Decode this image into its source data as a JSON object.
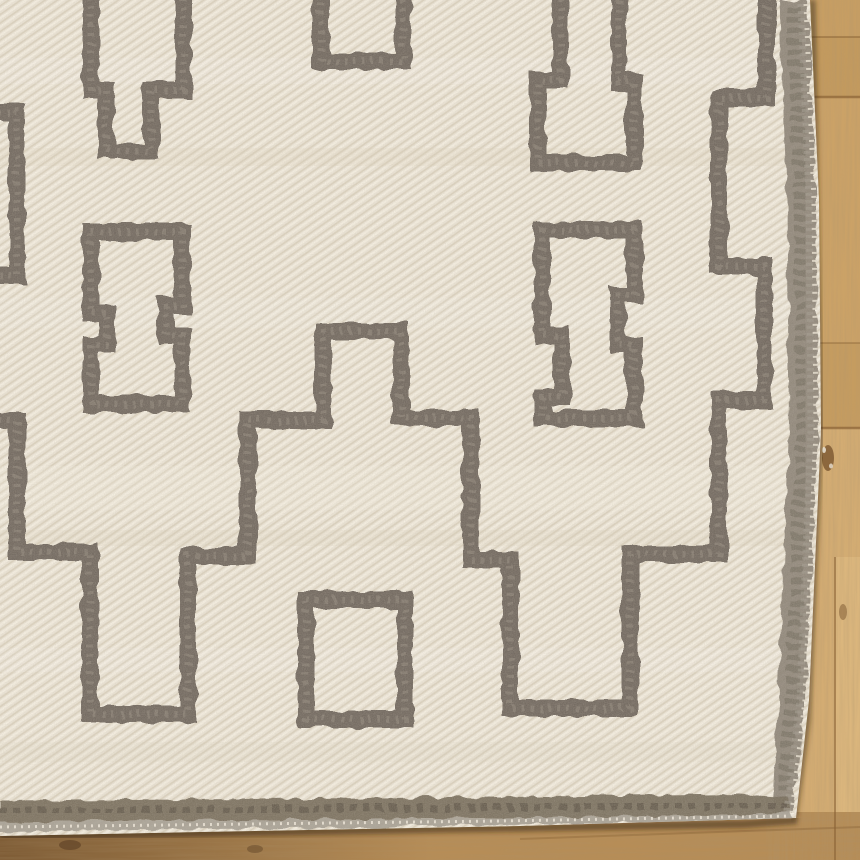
{
  "scene": {
    "description": "Close-up corner of a cream handwoven flatweave kilim rug with a charcoal-gray geometric Greek-key and stepped-medallion pattern, lying on a honey oak plank wood floor visible along the right side and bottom edge",
    "canvas": {
      "width": 860,
      "height": 860
    }
  },
  "palette": {
    "wood_base": "#c49b60",
    "wood_light_plank": "#d3ac73",
    "wood_seam": "#8a6336",
    "wood_shadow": "#3a2814",
    "rug_cream": "#eae3d5",
    "rug_cream_light": "#f4eee1",
    "rug_cream_dark": "#dbd2bf",
    "motif_gray": "#6c6259",
    "motif_fleck": "#9a9184",
    "border_gray": "#8b8377",
    "selvage_gray": "#a59e93"
  },
  "floor_shapes": [
    {
      "t": "rect",
      "n": "wood-base",
      "a": {
        "x": 0,
        "y": 0,
        "width": 860,
        "height": 860,
        "fill": "#c49b60"
      }
    },
    {
      "t": "rect",
      "n": "wood-plank",
      "a": {
        "x": 766,
        "y": 0,
        "width": 94,
        "height": 37,
        "fill": "#c79e63"
      }
    },
    {
      "t": "rect",
      "n": "wood-plank",
      "a": {
        "x": 766,
        "y": 37,
        "width": 94,
        "height": 60,
        "fill": "#c39a5e"
      }
    },
    {
      "t": "rect",
      "n": "wood-plank",
      "a": {
        "x": 766,
        "y": 97,
        "width": 94,
        "height": 246,
        "fill": "#cba267"
      }
    },
    {
      "t": "rect",
      "n": "wood-plank",
      "a": {
        "x": 766,
        "y": 343,
        "width": 94,
        "height": 85,
        "fill": "#c59c60"
      }
    },
    {
      "t": "rect",
      "n": "wood-plank",
      "a": {
        "x": 766,
        "y": 428,
        "width": 94,
        "height": 432,
        "fill": "#d3ac73"
      }
    },
    {
      "t": "rect",
      "n": "wood-plank",
      "a": {
        "x": 834,
        "y": 557,
        "width": 26,
        "height": 303,
        "fill": "#dbb67d"
      }
    },
    {
      "t": "rect",
      "n": "wood-plank",
      "a": {
        "x": 0,
        "y": 812,
        "width": 860,
        "height": 48,
        "fill": "#b68d57"
      }
    },
    {
      "t": "rect",
      "n": "wood-shading-bottom-left",
      "a": {
        "x": 0,
        "y": 812,
        "width": 430,
        "height": 48,
        "fill": "url(#gradBL)"
      }
    },
    {
      "t": "rect",
      "n": "wood-grain-vertical",
      "a": {
        "x": 766,
        "y": 0,
        "width": 94,
        "height": 860,
        "filter": "url(#grainV)",
        "opacity": "0.5"
      }
    },
    {
      "t": "rect",
      "n": "wood-grain-horizontal",
      "a": {
        "x": 0,
        "y": 812,
        "width": 860,
        "height": 48,
        "filter": "url(#grainH)",
        "opacity": "0.45"
      }
    },
    {
      "t": "path",
      "n": "plank-seam",
      "a": {
        "d": "M 766,37 H 860",
        "stroke": "#8a6336",
        "stroke-width": "2",
        "opacity": "0.5",
        "fill": "none"
      }
    },
    {
      "t": "path",
      "n": "plank-seam",
      "a": {
        "d": "M 766,97 H 860",
        "stroke": "#8a6336",
        "stroke-width": "2.5",
        "opacity": "0.7",
        "fill": "none"
      }
    },
    {
      "t": "path",
      "n": "plank-seam",
      "a": {
        "d": "M 766,343 H 860",
        "stroke": "#8a6336",
        "stroke-width": "2",
        "opacity": "0.4",
        "fill": "none"
      }
    },
    {
      "t": "path",
      "n": "plank-seam",
      "a": {
        "d": "M 766,428 H 860",
        "stroke": "#8a6336",
        "stroke-width": "2.5",
        "opacity": "0.7",
        "fill": "none"
      }
    },
    {
      "t": "path",
      "n": "plank-seam",
      "a": {
        "d": "M 835,557 V 860",
        "stroke": "#8a6336",
        "stroke-width": "2",
        "opacity": "0.6",
        "fill": "none"
      }
    },
    {
      "t": "path",
      "n": "plank-seam",
      "a": {
        "d": "M 520,839 L 860,827",
        "stroke": "#8a6336",
        "stroke-width": "2",
        "opacity": "0.4",
        "fill": "none"
      }
    },
    {
      "t": "ellipse",
      "n": "wood-knot",
      "a": {
        "cx": 828,
        "cy": 458,
        "rx": 6,
        "ry": 13,
        "fill": "#7a5630",
        "opacity": "0.8"
      }
    },
    {
      "t": "ellipse",
      "n": "wood-knot-speck",
      "a": {
        "cx": 824,
        "cy": 450,
        "rx": 2,
        "ry": 3,
        "fill": "#e8e0d0",
        "opacity": "0.9"
      }
    },
    {
      "t": "ellipse",
      "n": "wood-knot-speck",
      "a": {
        "cx": 831,
        "cy": 466,
        "rx": 2,
        "ry": 2.5,
        "fill": "#e8e0d0",
        "opacity": "0.8"
      }
    },
    {
      "t": "ellipse",
      "n": "wood-knot",
      "a": {
        "cx": 843,
        "cy": 612,
        "rx": 4,
        "ry": 8,
        "fill": "#7a5630",
        "opacity": "0.5"
      }
    },
    {
      "t": "ellipse",
      "n": "wood-knot",
      "a": {
        "cx": 70,
        "cy": 845,
        "rx": 11,
        "ry": 5,
        "fill": "#64472a",
        "opacity": "0.75"
      }
    },
    {
      "t": "ellipse",
      "n": "wood-knot",
      "a": {
        "cx": 255,
        "cy": 849,
        "rx": 8,
        "ry": 4,
        "fill": "#64472a",
        "opacity": "0.5"
      }
    },
    {
      "t": "path",
      "n": "rug-cast-shadow-right",
      "a": {
        "d": "M 812,0 L 820,430 L 807,720 L 794,818",
        "stroke": "rgba(58,40,20,0.5)",
        "stroke-width": "7",
        "fill": "none",
        "filter": "url(#soft)"
      }
    },
    {
      "t": "path",
      "n": "rug-cast-shadow-bottom",
      "a": {
        "d": "M 0,836 L 745,824 L 797,820",
        "stroke": "rgba(58,40,20,0.55)",
        "stroke-width": "8",
        "fill": "none",
        "filter": "url(#soft)"
      }
    }
  ],
  "rug": {
    "clip_d": "M 0,0 L 810,0 L 819,200 L 821,430 L 809,700 L 796,818 L 520,826 L 200,832 L 0,836 Z",
    "field": {
      "t": "rect",
      "n": "rug-field",
      "a": {
        "x": 0,
        "y": 0,
        "width": 860,
        "height": 860,
        "fill": "url(#twill)"
      }
    },
    "weave_bands": [
      {
        "y": 58,
        "h": 26,
        "fill": "#ffffff",
        "opacity": 0.1
      },
      {
        "y": 148,
        "h": 18,
        "fill": "#d7ccb7",
        "opacity": 0.16
      },
      {
        "y": 298,
        "h": 30,
        "fill": "#ffffff",
        "opacity": 0.08
      },
      {
        "y": 466,
        "h": 44,
        "fill": "#f6f0e2",
        "opacity": 0.22
      },
      {
        "y": 530,
        "h": 16,
        "fill": "#d7ccb7",
        "opacity": 0.18
      },
      {
        "y": 648,
        "h": 24,
        "fill": "#ffffff",
        "opacity": 0.1
      },
      {
        "y": 742,
        "h": 20,
        "fill": "#d7ccb7",
        "opacity": 0.14
      }
    ],
    "motif_style": {
      "color": "#6c6259",
      "width": 17,
      "fleck_color": "#9a9184",
      "fleck_width": 7,
      "fleck_dash": "3 6",
      "fleck_opacity": 0.45
    },
    "motifs": [
      {
        "name": "greek-key-medallion-band",
        "d": "M 767,-12 V 98 H 719 V 266 H 764 V 400 H 719 V 554 H 630 V 708 H 510 V 560 H 471 V 418 H 401 V 331 H 323 V 420 H 248 V 556 H 188 V 714 H 90 V 552 H 17 V 421 H -12"
      },
      {
        "name": "left-edge-key-tail",
        "d": "M -12,112 H 17 V 275 H -12"
      },
      {
        "name": "top-square-motif",
        "d": "M 321,-15 V 61 H 403 V -15"
      },
      {
        "name": "center-square-motif",
        "d": "M 306,600 H 405 V 719 H 306 Z"
      },
      {
        "name": "left-chain-fret-top",
        "d": "M 91,-12 V 90 H 106 V 151 H 151 V 90 H 183 V -12"
      },
      {
        "name": "left-chain-link",
        "d": "M 91,232 H 182 V 306 H 166 V 335 H 182 V 404 H 91 V 344 H 107 V 313 H 91 Z"
      },
      {
        "name": "right-chain-fret-top",
        "d": "M 560,-12 V 80 H 538 V 163 H 634 V 82 H 619 V -12"
      },
      {
        "name": "right-chain-link",
        "d": "M 542,230 H 634 V 295 H 618 V 345 H 634 V 418 H 542 V 397 H 562 V 335 H 542 Z"
      }
    ],
    "border_shapes": [
      {
        "t": "path",
        "n": "rug-border-right-band",
        "a": {
          "d": "M 779,0 L 787,200 L 789,430 L 778,700 L 772,812 L 793,814 L 806,700 L 818,430 L 816,200 L 808,0 Z",
          "fill": "#8b8377",
          "opacity": "0.92",
          "filter": "url(#wobble)"
        }
      },
      {
        "t": "path",
        "n": "rug-border-right-mottle",
        "a": {
          "d": "M 793,6 L 801,200 L 803,430 L 792,700 L 781,810",
          "stroke": "#6e665a",
          "stroke-width": "14",
          "stroke-dasharray": "6 5",
          "opacity": "0.45",
          "fill": "none",
          "filter": "url(#wobble)"
        }
      },
      {
        "t": "path",
        "n": "rug-border-bottom-band",
        "a": {
          "d": "M 0,801 L 500,797 L 740,794 L 789,798 L 791,812 L 740,815 L 500,818 L 0,822 Z",
          "fill": "#7a6f5f",
          "opacity": "0.95",
          "filter": "url(#wobble)"
        }
      },
      {
        "t": "path",
        "n": "rug-border-bottom-mottle",
        "a": {
          "d": "M 0,812 L 500,807 L 788,804",
          "stroke": "#574e42",
          "stroke-width": "8",
          "stroke-dasharray": "7 6",
          "opacity": "0.5",
          "fill": "none",
          "filter": "url(#wobble)"
        }
      },
      {
        "t": "path",
        "n": "rug-selvage-bottom",
        "a": {
          "d": "M 0,822 L 500,818 L 740,815 L 791,812 L 792,819 L 740,822 L 500,825 L 0,832 Z",
          "fill": "#a59e93",
          "opacity": "0.9",
          "filter": "url(#wobble)"
        }
      },
      {
        "t": "path",
        "n": "rug-selvage-ticks",
        "a": {
          "d": "M 0,827 L 500,821 L 791,816",
          "stroke": "#eee8db",
          "stroke-width": "3",
          "stroke-dasharray": "2 5",
          "opacity": "0.85",
          "fill": "none"
        }
      },
      {
        "t": "path",
        "n": "rug-fringe-fuzz-right",
        "a": {
          "d": "M 801,4 L 809,200 L 811,430 L 800,700 L 787,812",
          "stroke": "#a29b8f",
          "stroke-width": "7",
          "stroke-dasharray": "3 4",
          "opacity": "0.6",
          "fill": "none"
        }
      },
      {
        "t": "path",
        "n": "rug-fringe-ticks-right",
        "a": {
          "d": "M 806,4 L 814,200 L 816,430 L 805,700 L 792,813",
          "stroke": "#e3dccd",
          "stroke-width": "5",
          "stroke-dasharray": "2 6",
          "opacity": "0.9",
          "fill": "none"
        }
      }
    ],
    "overlay": {
      "t": "rect",
      "n": "rug-speckle-texture",
      "a": {
        "x": 0,
        "y": 0,
        "width": 860,
        "height": 860,
        "filter": "url(#speck)",
        "opacity": "0.32"
      }
    }
  }
}
